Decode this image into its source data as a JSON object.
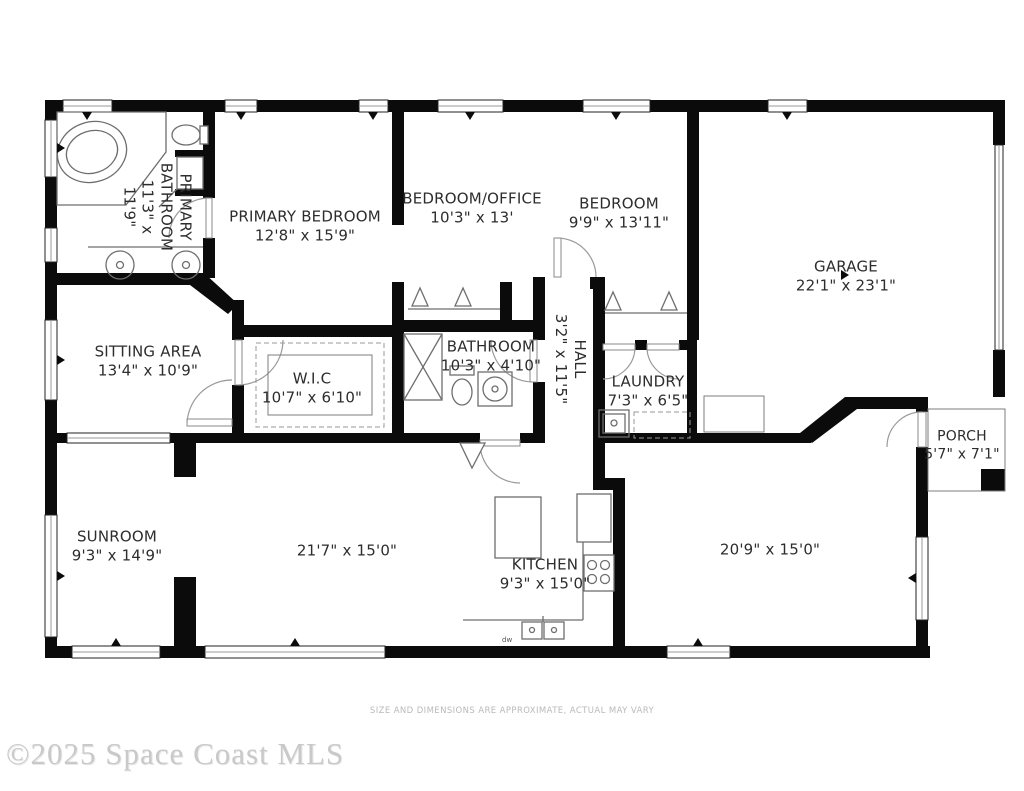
{
  "rooms": [
    {
      "id": "primary-bathroom",
      "name": "PRIMARY BATHROOM",
      "dims": "11'3\" x 11'9\""
    },
    {
      "id": "primary-bedroom",
      "name": "PRIMARY BEDROOM",
      "dims": "12'8\" x 15'9\""
    },
    {
      "id": "bedroom-office",
      "name": "BEDROOM/OFFICE",
      "dims": "10'3\" x 13'"
    },
    {
      "id": "bedroom",
      "name": "BEDROOM",
      "dims": "9'9\" x 13'11\""
    },
    {
      "id": "garage",
      "name": "GARAGE",
      "dims": "22'1\" x 23'1\""
    },
    {
      "id": "sitting-area",
      "name": "SITTING AREA",
      "dims": "13'4\" x 10'9\""
    },
    {
      "id": "wic",
      "name": "W.I.C",
      "dims": "10'7\" x 6'10\""
    },
    {
      "id": "bathroom",
      "name": "BATHROOM",
      "dims": "10'3\" x 4'10\""
    },
    {
      "id": "hall",
      "name": "HALL",
      "dims": "3'2\" x 11'5\""
    },
    {
      "id": "laundry",
      "name": "LAUNDRY",
      "dims": "7'3\" x 6'5\""
    },
    {
      "id": "porch",
      "name": "PORCH",
      "dims": "5'7\" x 7'1\""
    },
    {
      "id": "sunroom",
      "name": "SUNROOM",
      "dims": "9'3\" x 14'9\""
    },
    {
      "id": "living-area",
      "name": "",
      "dims": "21'7\" x 15'0\""
    },
    {
      "id": "kitchen",
      "name": "KITCHEN",
      "dims": "9'3\" x 15'0\""
    },
    {
      "id": "family-room",
      "name": "",
      "dims": "20'9\" x 15'0\""
    }
  ],
  "kitchen_fixture_labels": {
    "dishwasher": "dw"
  },
  "footer": {
    "disclaimer": "SIZE AND DIMENSIONS ARE APPROXIMATE, ACTUAL MAY VARY",
    "watermark": "©2025 Space Coast MLS"
  },
  "colors": {
    "wall": "#0b0b0b",
    "fixture": "#6e6e6e",
    "door": "#8a8a8a",
    "label": "#2d2d2d",
    "disclaimer": "#b9b9b9",
    "watermark": "#c9c9c9"
  }
}
